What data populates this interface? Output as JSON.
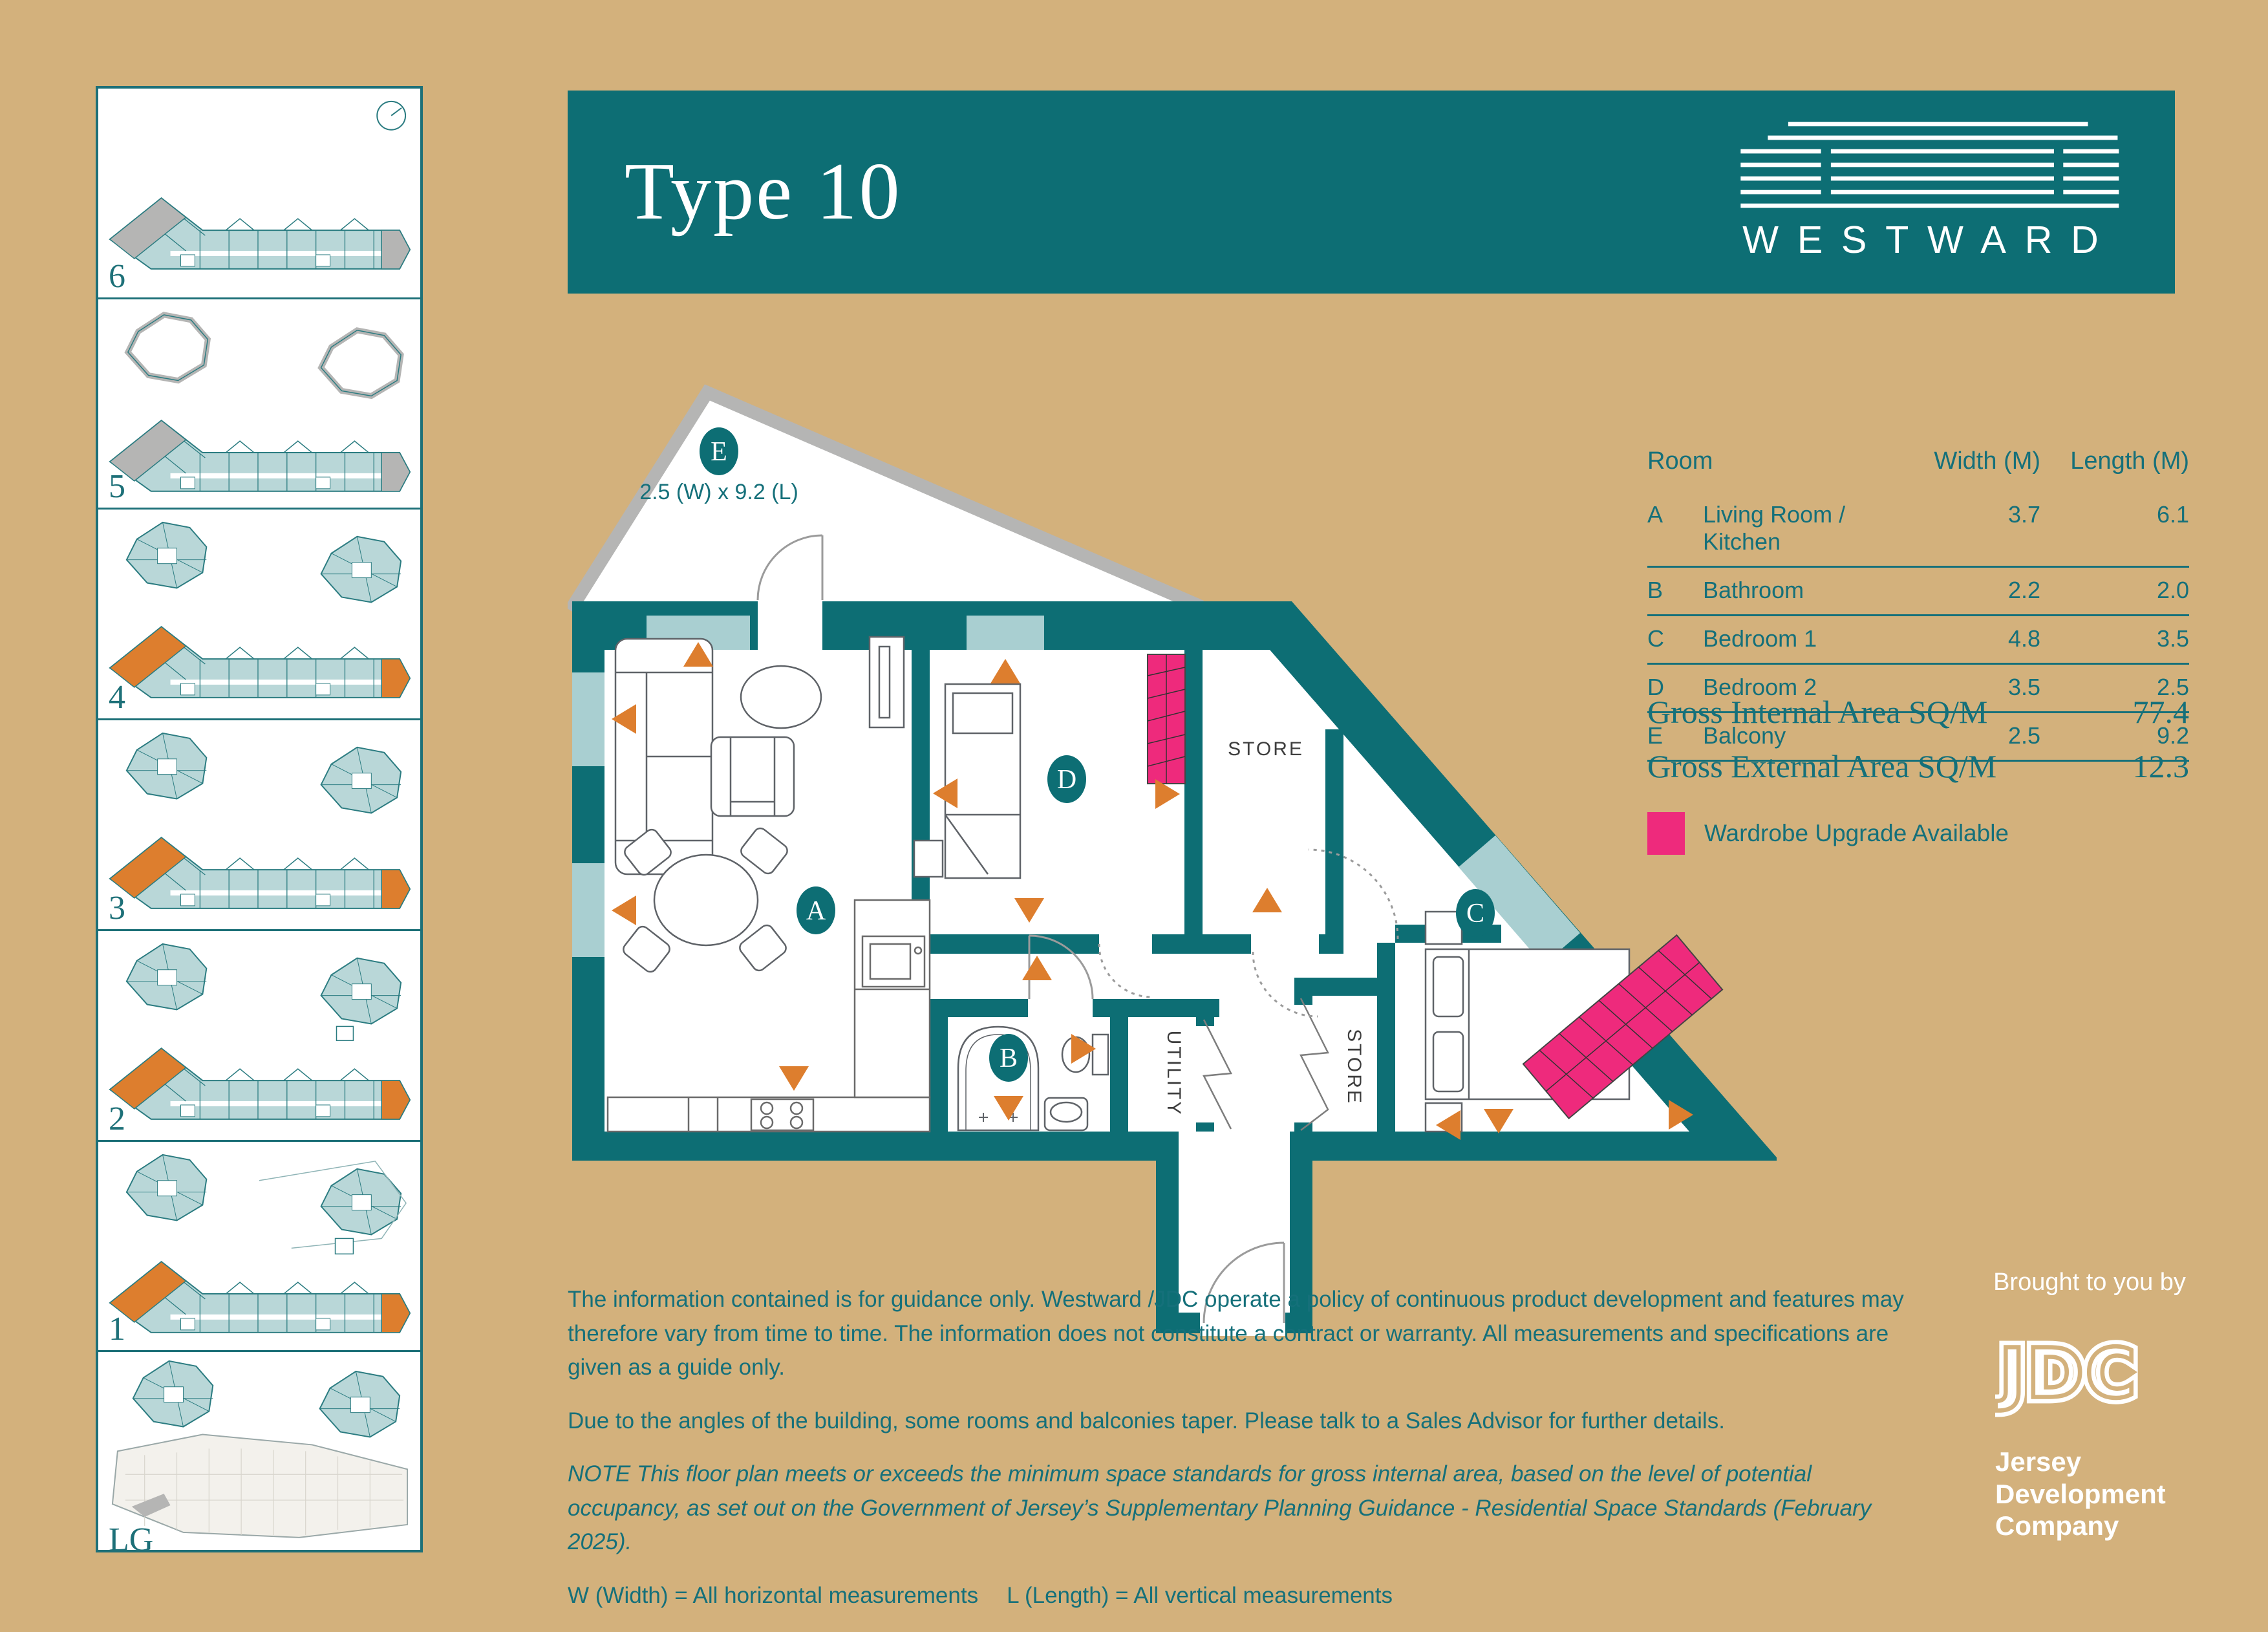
{
  "header": {
    "title": "Type 10",
    "brand": "WESTWARD"
  },
  "sidebar": {
    "floors": [
      {
        "label": "6"
      },
      {
        "label": "5"
      },
      {
        "label": "4"
      },
      {
        "label": "3"
      },
      {
        "label": "2"
      },
      {
        "label": "1"
      },
      {
        "label": "LG"
      }
    ]
  },
  "plan": {
    "balcony": {
      "label": "E",
      "dimension": "2.5 (W) x 9.2 (L)"
    },
    "rooms": {
      "living": "A",
      "bathroom": "B",
      "bedroom1": "C",
      "bedroom2": "D"
    },
    "store_top": "STORE",
    "store_mid": "STORE",
    "utility": "UTILITY"
  },
  "table": {
    "headers": {
      "room": "Room",
      "width": "Width (M)",
      "length": "Length (M)"
    },
    "rows": [
      {
        "key": "A",
        "name": "Living Room / Kitchen",
        "width": "3.7",
        "length": "6.1"
      },
      {
        "key": "B",
        "name": "Bathroom",
        "width": "2.2",
        "length": "2.0"
      },
      {
        "key": "C",
        "name": "Bedroom 1",
        "width": "4.8",
        "length": "3.5"
      },
      {
        "key": "D",
        "name": "Bedroom 2",
        "width": "3.5",
        "length": "2.5"
      },
      {
        "key": "E",
        "name": "Balcony",
        "width": "2.5",
        "length": "9.2"
      }
    ]
  },
  "areas": {
    "internal_label": "Gross Internal Area SQ/M",
    "internal_value": "77.4",
    "external_label": "Gross External Area SQ/M",
    "external_value": "12.3"
  },
  "legend": {
    "wardrobe": "Wardrobe Upgrade Available"
  },
  "disclaimer": {
    "p1": "The information contained is for guidance only. Westward /JDC operate a policy of continuous product development and features may therefore vary from time to time. The information does not constitute a contract or warranty. All measurements and specifications are given as a guide only.",
    "p2": "Due to the angles of the building, some rooms and balconies taper. Please talk to a Sales Advisor for further details.",
    "note": "NOTE This floor plan meets or exceeds the minimum space standards for gross internal area, based on the level of potential occupancy, as set out on the Government of Jersey’s Supplementary Planning Guidance - Residential Space Standards (February 2025).",
    "measurements_w": "W (Width) = All horizontal measurements",
    "measurements_l": "L (Length) = All vertical measurements"
  },
  "footer": {
    "brought_by": "Brought to you by",
    "monogram": "JDC",
    "company": [
      "Jersey",
      "Development",
      "Company"
    ]
  }
}
